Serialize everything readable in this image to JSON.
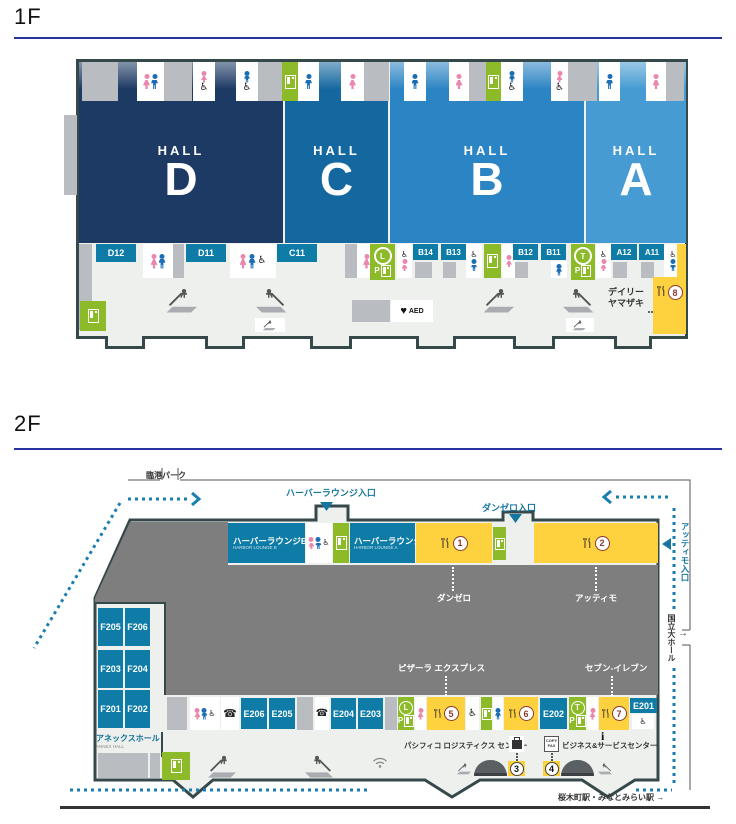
{
  "colors": {
    "hall_d": "#1d3a64",
    "hall_c": "#15689f",
    "hall_b": "#2b85c4",
    "hall_a": "#459bd2",
    "room_teal": "#0f7ca7",
    "facility_green": "#8cba29",
    "restaurant_yellow": "#fdd23e",
    "route_blue": "#1a7fae",
    "marker_red": "#8b3a2e",
    "wall_dark": "#35494b"
  },
  "floor1": {
    "title": "1F",
    "hall_word": "HALL",
    "halls": [
      "D",
      "C",
      "B",
      "A"
    ],
    "rooms": [
      "D12",
      "D11",
      "C11",
      "B14",
      "B13",
      "B12",
      "B11",
      "A12",
      "A11"
    ],
    "parking": {
      "l": "L",
      "t": "T",
      "p": "P"
    },
    "aed_label": "AED",
    "shop": {
      "line1": "デイリー",
      "line2": "ヤマザキ",
      "number": "8"
    }
  },
  "floor2": {
    "title": "2F",
    "outside": {
      "rinko_park": "臨港パーク",
      "harbor_entrance": "ハーバーラウンジ入口",
      "danzero_entrance": "ダンゼロ入口",
      "attimo_entrance": "アッティモ入口",
      "kokuritsu_hall": "国立大ホール",
      "arrow_right": "→",
      "station": "桜木町駅・みなとみらい駅 →"
    },
    "lounges": {
      "b_jp": "ハーバーラウンジB",
      "b_en": "HARBOR LOUNGE B",
      "a_jp": "ハーバーラウンジA",
      "a_en": "HARBOR LOUNGE A"
    },
    "hall_labels": {
      "danzero": "ダンゼロ",
      "attimo": "アッティモ"
    },
    "shops": {
      "pizzala": "ピザーラ エクスプレス",
      "seven": "セブン-イレブン"
    },
    "annex": {
      "jp": "アネックスホール",
      "en": "ANNEX HALL",
      "rooms": [
        "F205",
        "F206",
        "F203",
        "F204",
        "F201",
        "F202"
      ]
    },
    "e_rooms": [
      "E206",
      "E205",
      "E204",
      "E203",
      "E202",
      "E201"
    ],
    "markers": {
      "n1": "1",
      "n2": "2",
      "n3": "3",
      "n4": "4",
      "n5": "5",
      "n6": "6",
      "n7": "7"
    },
    "services": {
      "logistics": "パシフィコ ロジスティクス センター",
      "business": "ビジネス&サービスセンター",
      "copy": "COPY",
      "fax": "FAX",
      "info": "i"
    },
    "parking": {
      "l": "L",
      "t": "T",
      "p": "P"
    }
  }
}
